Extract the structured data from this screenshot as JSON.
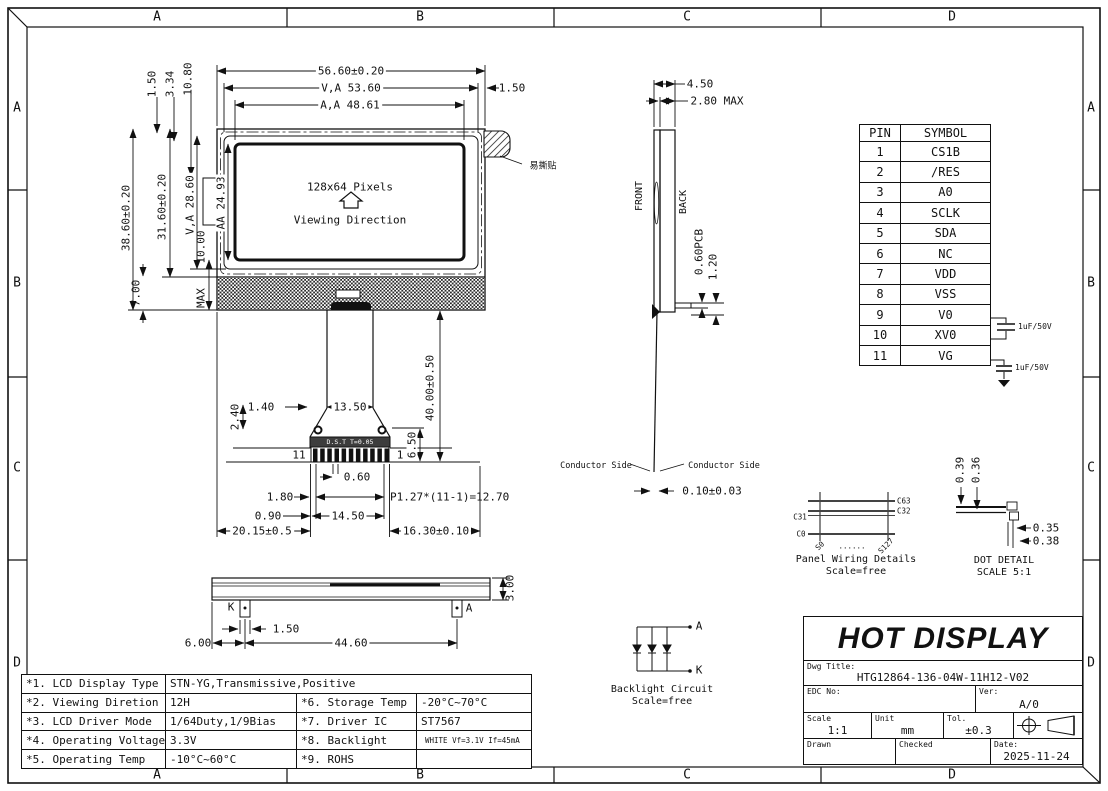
{
  "colors": {
    "line": "#111111",
    "paper": "#ffffff"
  },
  "border": {
    "cols": [
      "A",
      "B",
      "C",
      "D"
    ],
    "rows": [
      "A",
      "B",
      "C",
      "D"
    ]
  },
  "front_view": {
    "pixels_label": "128x64 Pixels",
    "viewing_label": "Viewing Direction",
    "sticker_label": "易撕贴",
    "dims": {
      "total_width": "56.60±0.20",
      "va_width": "V,A 53.60",
      "aa_width": "A,A 48.61",
      "right_margin": "1.50",
      "top_off1": "1.50",
      "top_off2": "3.34",
      "top_off3": "10.80",
      "total_height": "38.60±0.20",
      "glass_height": "31.60±0.20",
      "va_height": "V,A 28.60",
      "aa_height": "AA 24.93",
      "bl_gap": "10.00",
      "bl_gap_max": "MAX",
      "bottom_h": "7.00"
    }
  },
  "connector": {
    "strip_label": "D.S.T T=0.05",
    "pin_left": "11",
    "pin_right": "1",
    "dims": {
      "d240": "2.40",
      "d140": "1.40",
      "d1350": "13.50",
      "d650": "6.50",
      "d4000": "40.00±0.50",
      "d060": "0.60",
      "d180": "1.80",
      "pitch": "P1.27*(11-1)=12.70",
      "d090": "0.90",
      "d1450": "14.50",
      "d2015": "20.15±0.5",
      "d1630": "16.30±0.10"
    }
  },
  "bottom_view": {
    "k_label": "K",
    "a_label": "A",
    "dims": {
      "d600": "6.00",
      "d150": "1.50",
      "d4460": "44.60",
      "d300": "3.00"
    }
  },
  "side_view": {
    "front_label": "FRONT",
    "back_label": "BACK",
    "conductor_left": "Conductor Side",
    "conductor_right": "Conductor Side",
    "dims": {
      "d450": "4.50",
      "d280": "2.80 MAX",
      "pcb": "0.60PCB",
      "d120": "1.20",
      "d010": "0.10±0.03"
    }
  },
  "pin_table": {
    "headers": {
      "pin": "PIN",
      "symbol": "SYMBOL"
    },
    "rows": [
      {
        "pin": "1",
        "symbol": "CS1B"
      },
      {
        "pin": "2",
        "symbol": "/RES"
      },
      {
        "pin": "3",
        "symbol": "A0"
      },
      {
        "pin": "4",
        "symbol": "SCLK"
      },
      {
        "pin": "5",
        "symbol": "SDA"
      },
      {
        "pin": "6",
        "symbol": "NC"
      },
      {
        "pin": "7",
        "symbol": "VDD"
      },
      {
        "pin": "8",
        "symbol": "VSS"
      },
      {
        "pin": "9",
        "symbol": "V0"
      },
      {
        "pin": "10",
        "symbol": "XV0"
      },
      {
        "pin": "11",
        "symbol": "VG"
      }
    ],
    "cap1_label": "1uF/50V",
    "cap2_label": "1uF/50V"
  },
  "panel_wiring": {
    "c63": "C63",
    "c32": "C32",
    "c31": "C31",
    "c0": "C0",
    "s0": "S0",
    "s127": "S127",
    "dots": "......",
    "title": "Panel Wiring Details",
    "scale": "Scale=free"
  },
  "dot_detail": {
    "d039": "0.39",
    "d036": "0.36",
    "d035": "0.35",
    "d038": "0.38",
    "title": "DOT DETAIL",
    "scale": "SCALE 5:1"
  },
  "backlight_circuit": {
    "a_label": "A",
    "k_label": "K",
    "title": "Backlight Circuit",
    "scale": "Scale=free"
  },
  "spec_table": {
    "rows": [
      {
        "c0": "*1. LCD Display Type",
        "c1": "STN-YG,Transmissive,Positive",
        "c2": "",
        "c3": ""
      },
      {
        "c0": "*2. Viewing Diretion",
        "c1": "12H",
        "c2": "*6. Storage Temp",
        "c3": "-20°C~70°C"
      },
      {
        "c0": "*3. LCD Driver Mode",
        "c1": "1/64Duty,1/9Bias",
        "c2": "*7. Driver IC",
        "c3": "ST7567"
      },
      {
        "c0": "*4. Operating Voltage",
        "c1": "3.3V",
        "c2": "*8. Backlight",
        "c3": "WHITE Vf=3.1V If=45mA"
      },
      {
        "c0": "*5. Operating Temp",
        "c1": "-10°C~60°C",
        "c2": "*9. ROHS",
        "c3": ""
      }
    ]
  },
  "title_block": {
    "company": "HOT DISPLAY",
    "dwg_title_label": "Dwg Title:",
    "dwg_title": "HTG12864-136-04W-11H12-V02",
    "edc_label": "EDC No:",
    "ver_label": "Ver:",
    "ver": "A/0",
    "scale_label": "Scale",
    "scale": "1:1",
    "unit_label": "Unit",
    "unit": "mm",
    "tol_label": "Tol.",
    "tol": "±0.3",
    "drawn_label": "Drawn",
    "checked_label": "Checked",
    "date_label": "Date:",
    "date": "2025-11-24"
  }
}
